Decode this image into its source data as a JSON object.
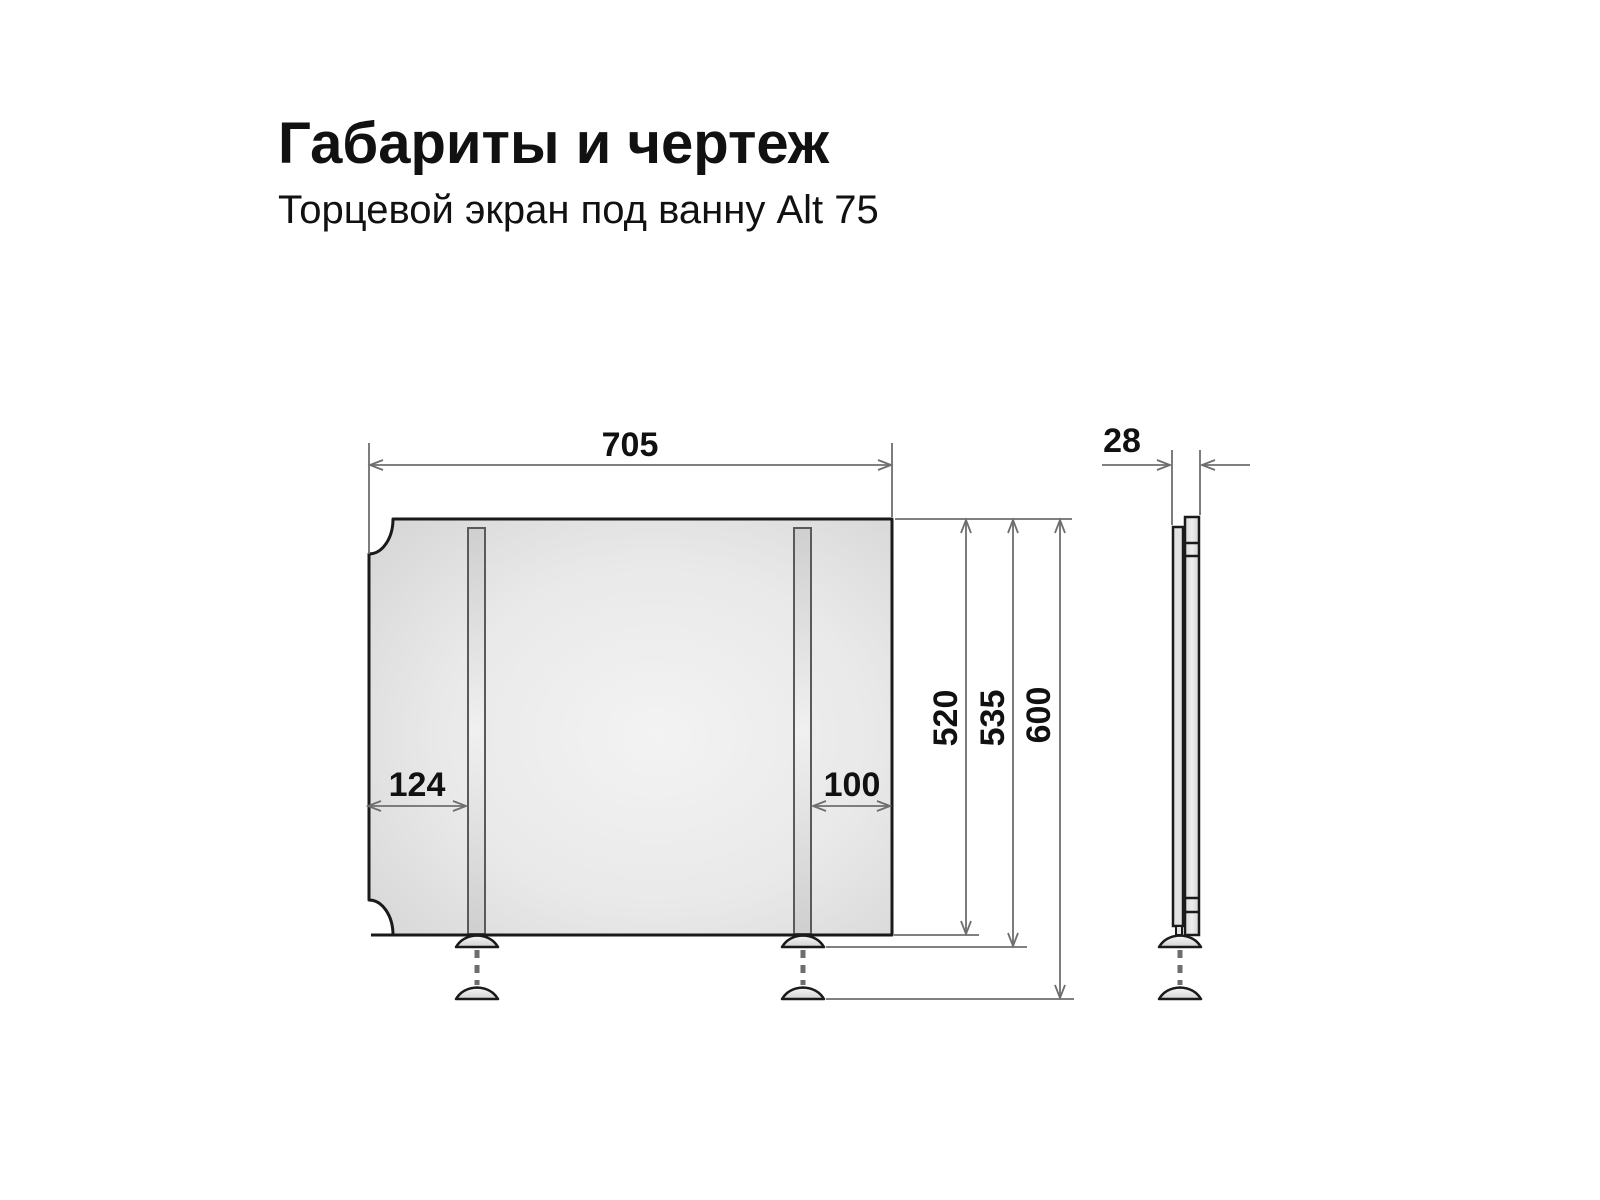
{
  "header": {
    "title": "Габариты и чертеж",
    "subtitle": "Торцевой экран под ванну Alt 75"
  },
  "front_view": {
    "width_mm": "705",
    "left_leg_offset_mm": "124",
    "right_leg_offset_mm": "100",
    "panel_height_mm": "520",
    "height_with_feet_mm": "535",
    "max_height_mm": "600"
  },
  "side_view": {
    "thickness_mm": "28"
  },
  "colors": {
    "background": "#ffffff",
    "outline": "#1a1a1a",
    "dimension_line": "#6e6e6e",
    "text": "#111111",
    "panel_fill_light": "#f3f3f3",
    "panel_fill_dark": "#d5d5d5"
  }
}
